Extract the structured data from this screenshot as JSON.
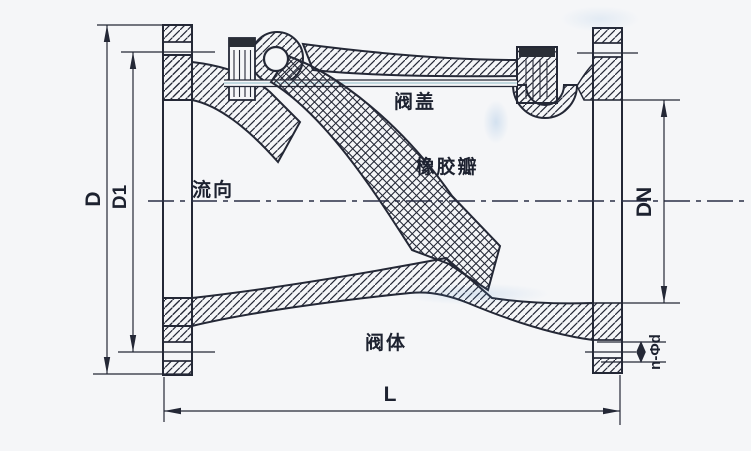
{
  "drawing": {
    "part_labels": {
      "bonnet": "阀盖",
      "rubber_flap": "橡胶瓣",
      "flow_direction": "流向",
      "valve_body": "阀体"
    },
    "dimension_labels": {
      "outer_diameter": "D",
      "bolt_circle_diameter": "D1",
      "nominal_bore": "DN",
      "face_to_face_length": "L",
      "bolt_holes": "n-Φd"
    },
    "colors": {
      "paper": "#f5f6f8",
      "ink": "#242836",
      "centerline": "#2a2f45",
      "scan_tint": "#3e8ea0",
      "cap_dark": "#2a2e36"
    }
  }
}
